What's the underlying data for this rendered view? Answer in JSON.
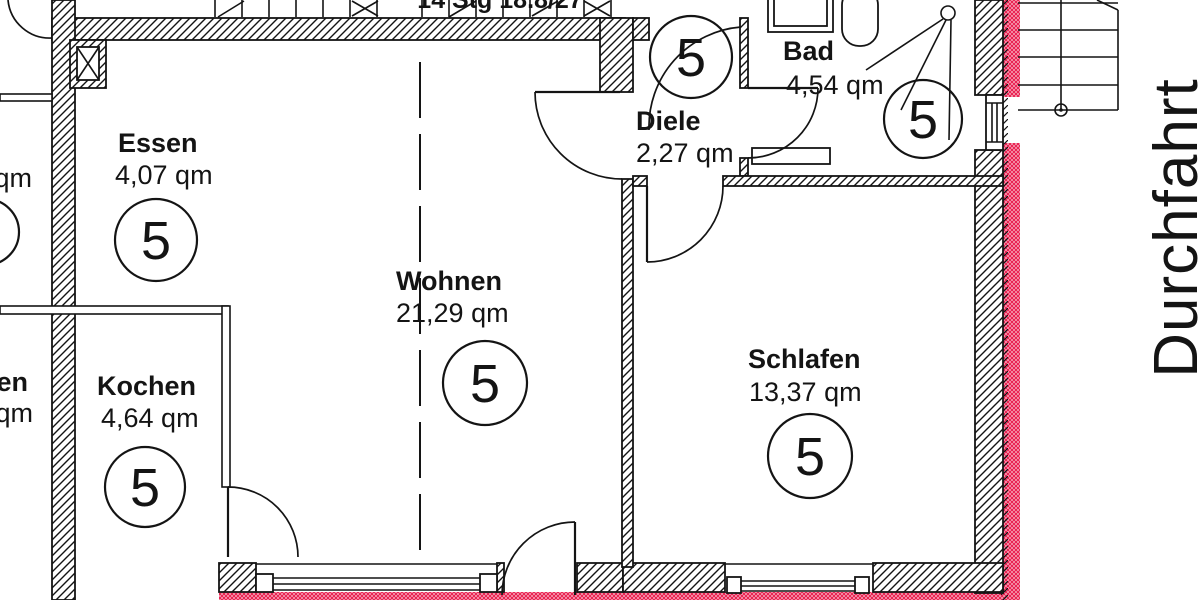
{
  "meta": {
    "kind": "architectural-floor-plan",
    "language": "de"
  },
  "colors": {
    "line": "#141414",
    "marking_red": "#e8194a",
    "background": "#ffffff"
  },
  "rooms": [
    {
      "name": "Essen",
      "area": "4,07 qm",
      "unit": "5"
    },
    {
      "name": "Kochen",
      "area": "4,64 qm",
      "unit": "5"
    },
    {
      "name": "Wohnen",
      "area": "21,29 qm",
      "unit": "5"
    },
    {
      "name": "Diele",
      "area": "2,27 qm",
      "unit": "5"
    },
    {
      "name": "Bad",
      "area": "4,54 qm",
      "unit": "5"
    },
    {
      "name": "Schlafen",
      "area": "13,37 qm",
      "unit": "5"
    }
  ],
  "annotations": {
    "passage_label": "Durchfahrt",
    "stair_note": "14 Stg 18.8/27",
    "neighbor_fragments": [
      "qm",
      "en",
      "qm"
    ]
  }
}
